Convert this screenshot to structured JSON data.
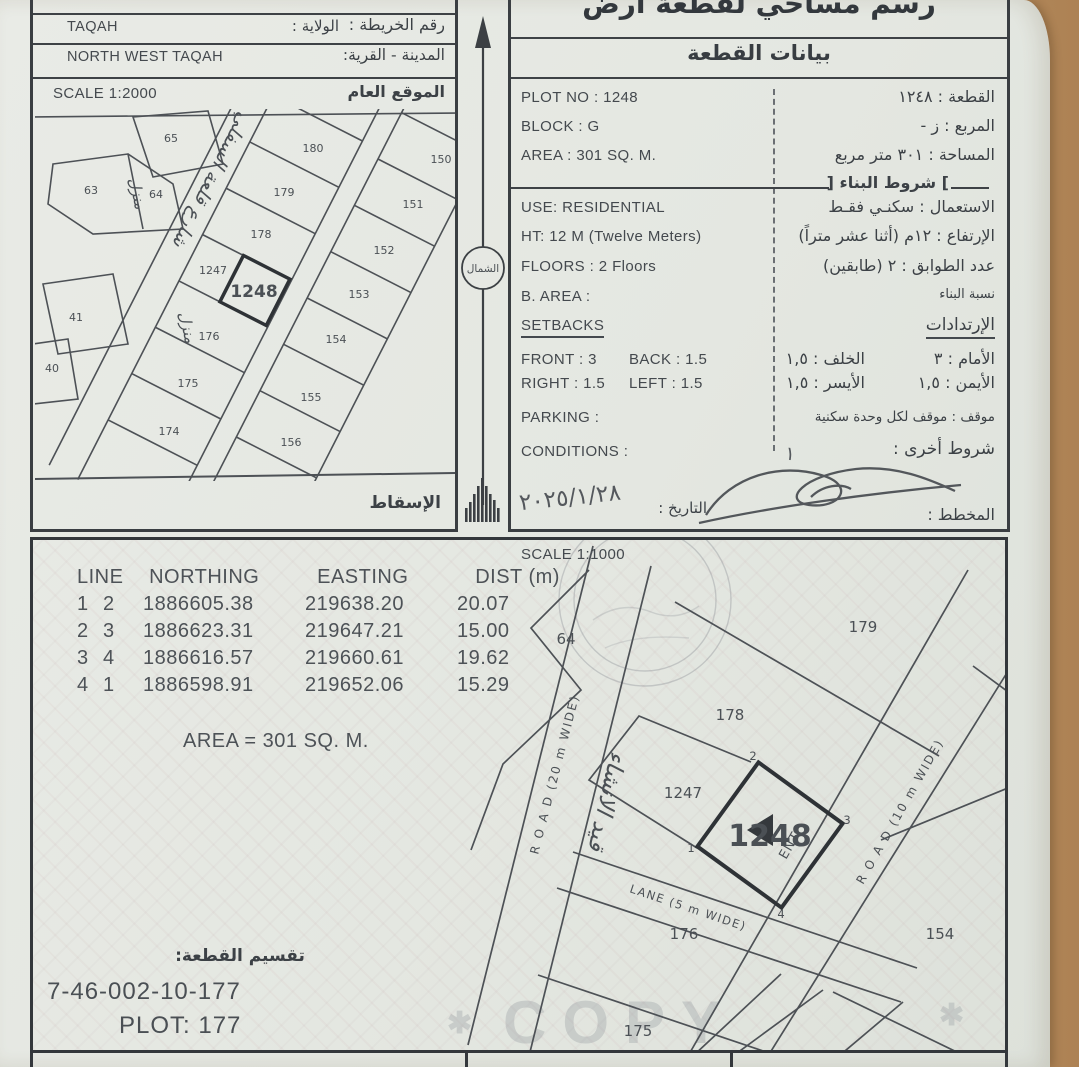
{
  "top_left": {
    "map_no_label": "رقم الخريطة :",
    "wilaya_label": "الولاية :",
    "wilaya_value": "TAQAH",
    "town_label": "المدينة - القرية:",
    "town_value": "NORTH WEST TAQAH",
    "general_location_label": "الموقع العام",
    "scale_label": "SCALE 1:2000",
    "projection_label": "الإسقاط"
  },
  "location_map": {
    "highlight": "1248",
    "street_handwriting": "شارع قلعة السفلي",
    "house_handwriting": "منزل",
    "nums": [
      "65",
      "63",
      "64",
      "41",
      "40",
      "180",
      "179",
      "178",
      "1247",
      "1248",
      "176",
      "175",
      "174",
      "150",
      "151",
      "152",
      "153",
      "154",
      "155",
      "156"
    ]
  },
  "north": {
    "label": "الشمال"
  },
  "title": {
    "main": "رسم مساحي لقطعة أرض",
    "section": "بيانات القطعة"
  },
  "plot_data": {
    "en": {
      "plot_no": "PLOT NO : 1248",
      "block": "BLOCK : G",
      "area": "AREA : 301 SQ. M.",
      "use": "USE: RESIDENTIAL",
      "ht": "HT: 12 M (Twelve Meters)",
      "floors": "FLOORS : 2 Floors",
      "b_area": "B. AREA :",
      "setbacks": "SETBACKS",
      "front": "FRONT : 3",
      "back": "BACK : 1.5",
      "right": "RIGHT : 1.5",
      "left": "LEFT : 1.5",
      "parking": "PARKING :",
      "conditions": "CONDITIONS :"
    },
    "ar": {
      "plot": "القطعة : ١٢٤٨",
      "block": "المربع : ز -",
      "area": "المساحة :  ٣٠١  متر مربع",
      "building_rules": "شروط البناء",
      "use": "الاستعمال : سكنـي فقـط",
      "ht": "الإرتفاع : ١٢م (أثنا عشر متراً)",
      "floors": "عدد الطوابق : ٢ (طابقين)",
      "b_ratio": "نسبة البناء",
      "setbacks": "الإرتدادات",
      "front": "الأمام : ٣",
      "back": "الخلف : ١,٥",
      "right_lbl": "الأيمن : ١,٥",
      "left_lbl": "الأيسر : ١,٥",
      "parking": "موقف : موقف لكل وحدة سكنية",
      "other": "شروط أخرى :",
      "other_note": "١",
      "planner": "المخطط :",
      "date_label": "التاريخ :"
    },
    "date_handwritten": "٢٠٢٥/١/٢٨"
  },
  "survey_table": {
    "headers": [
      "LINE",
      "NORTHING",
      "EASTING",
      "DIST (m)"
    ],
    "rows": [
      [
        "1",
        "2",
        "1886605.38",
        "219638.20",
        "20.07"
      ],
      [
        "2",
        "3",
        "1886623.31",
        "219647.21",
        "15.00"
      ],
      [
        "3",
        "4",
        "1886616.57",
        "219660.61",
        "19.62"
      ],
      [
        "4",
        "1",
        "1886598.91",
        "219652.06",
        "15.29"
      ]
    ],
    "area_total": "AREA = 301 SQ. M."
  },
  "site_plan": {
    "scale": "SCALE 1:1000",
    "plot_number": "1248",
    "handwriting": "قيد الانشاء",
    "ent": "ENT",
    "road_left": "R O A D  (20 m WIDE)",
    "road_right": "R O A D  (10 m WIDE)",
    "lane": "LANE  (5 m WIDE)",
    "corners": [
      "1",
      "2",
      "3",
      "4"
    ],
    "nums": [
      "64",
      "179",
      "178",
      "1247",
      "176",
      "154",
      "175"
    ]
  },
  "subdivision": {
    "label": "تقسيم القطعة:",
    "code": "7-46-002-10-177",
    "plot": "PLOT: 177"
  },
  "watermark": {
    "text": "COPY",
    "star": "✱"
  }
}
